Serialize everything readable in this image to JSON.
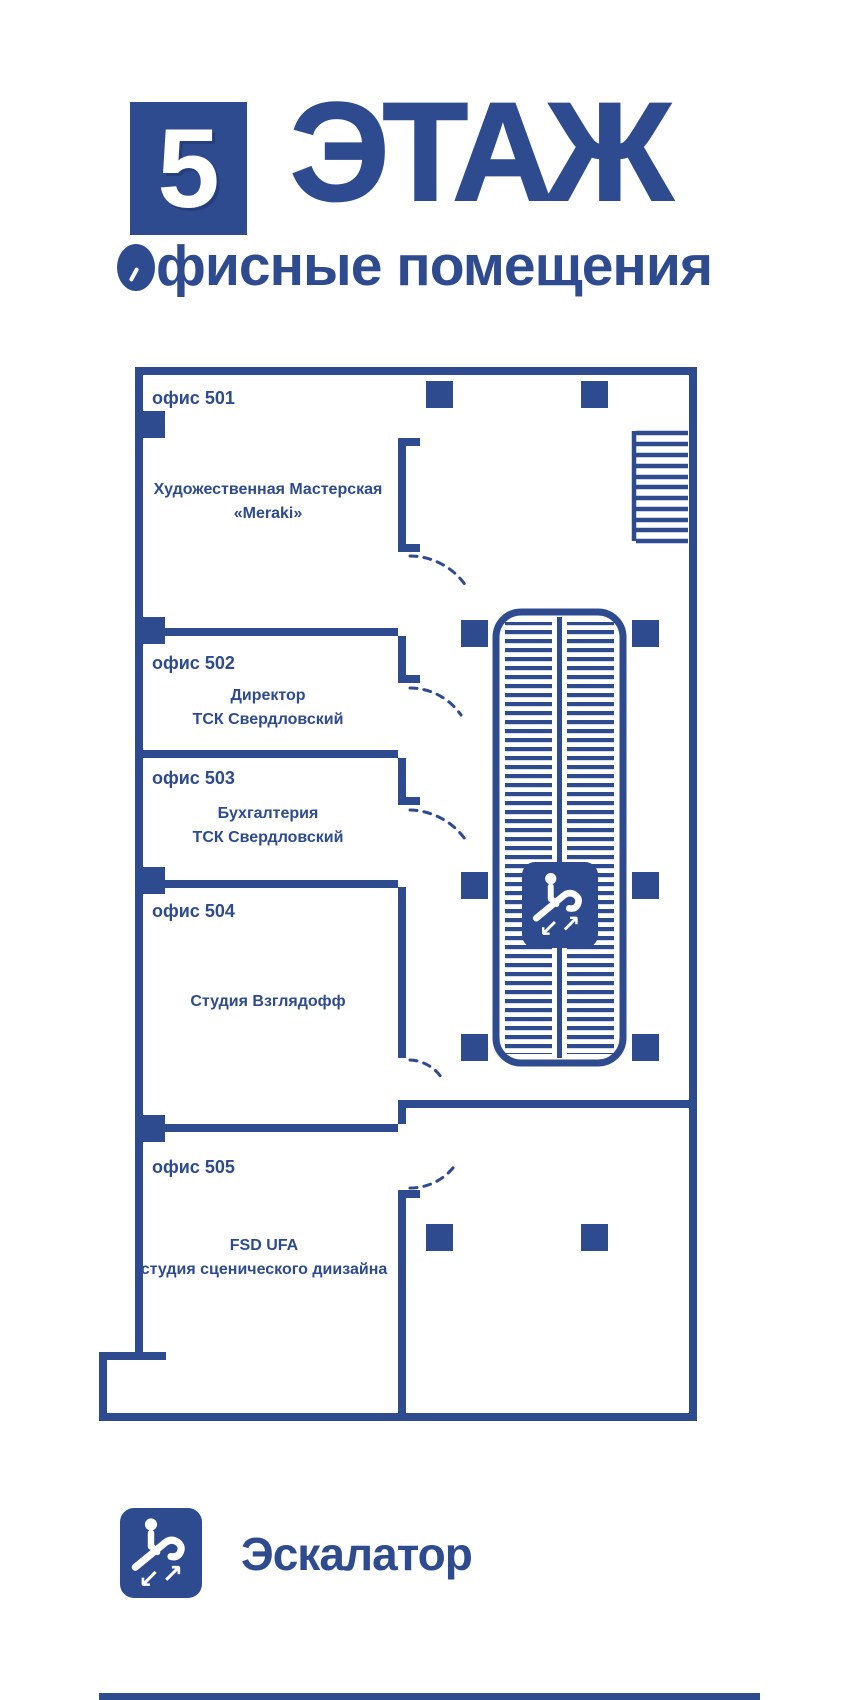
{
  "colors": {
    "primary": "#2e4b90",
    "background": "#ffffff"
  },
  "header": {
    "floor_number": "5",
    "floor_word": "ЭТАЖ",
    "subtitle": "Офисные помещения",
    "subtitle_rest": "фисные помещения"
  },
  "plan": {
    "offices": [
      {
        "label": "офис 501",
        "tenant": [
          "Художественная Мастерская",
          "«Meraki»"
        ]
      },
      {
        "label": "офис 502",
        "tenant": [
          "Директор",
          "ТСК Свердловский"
        ]
      },
      {
        "label": "офис 503",
        "tenant": [
          "Бухгалтерия",
          "ТСК Свердловский"
        ]
      },
      {
        "label": "офис 504",
        "tenant": [
          "Студия Взглядофф",
          ""
        ]
      },
      {
        "label": "офис 505",
        "tenant": [
          "FSD UFA",
          "студия сценического диизайна"
        ]
      }
    ],
    "escalator_badge_icon": "escalator-icon",
    "stairs_icon": "stairs-icon"
  },
  "glyphs": {
    "arrow_dl": "↙",
    "arrow_ur": "↗"
  },
  "legend": {
    "escalator": {
      "icon": "escalator-icon",
      "label": "Эскалатор"
    }
  }
}
